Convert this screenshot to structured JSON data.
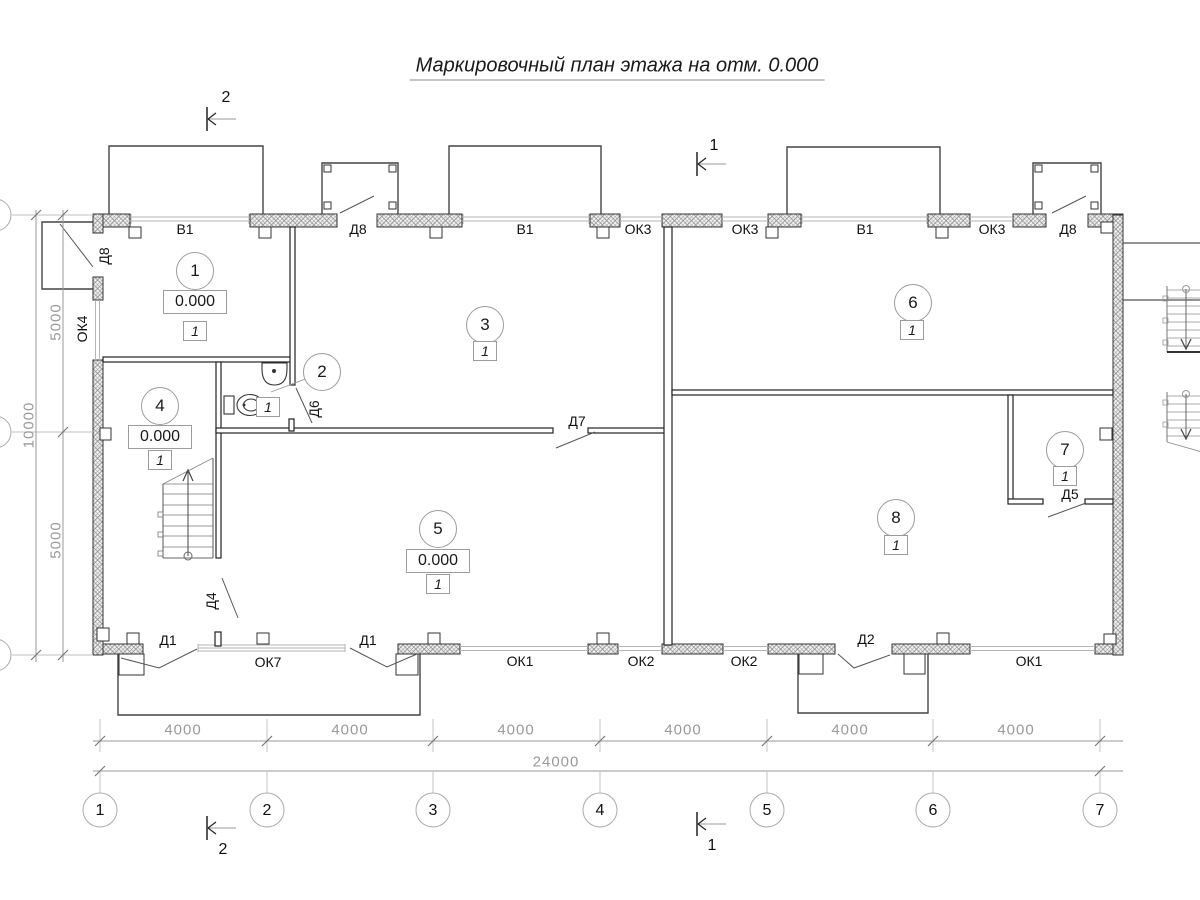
{
  "title": "Маркировочный план этажа на отм. 0.000",
  "rooms": {
    "r1": {
      "num": "1",
      "elev": "0.000",
      "fin": "1"
    },
    "r2": {
      "num": "2",
      "fin": "1"
    },
    "r3": {
      "num": "3",
      "fin": "1"
    },
    "r4": {
      "num": "4",
      "elev": "0.000",
      "fin": "1"
    },
    "r5": {
      "num": "5",
      "elev": "0.000",
      "fin": "1"
    },
    "r6": {
      "num": "6",
      "fin": "1"
    },
    "r7": {
      "num": "7",
      "fin": "1"
    },
    "r8": {
      "num": "8",
      "fin": "1"
    }
  },
  "labels": {
    "v1": "В1",
    "d8": "Д8",
    "ok3": "ОК3",
    "ok4": "ОК4",
    "d6": "Д6",
    "d7": "Д7",
    "d5": "Д5",
    "d4": "Д4",
    "d1": "Д1",
    "d2": "Д2",
    "ok7": "ОК7",
    "ok1": "ОК1",
    "ok2": "ОК2"
  },
  "dims": {
    "bay": "4000",
    "total": "24000",
    "v5000": "5000",
    "v10000": "10000"
  },
  "axes": [
    "1",
    "2",
    "3",
    "4",
    "5",
    "6",
    "7"
  ],
  "sections": {
    "s1": "1",
    "s2": "2"
  }
}
